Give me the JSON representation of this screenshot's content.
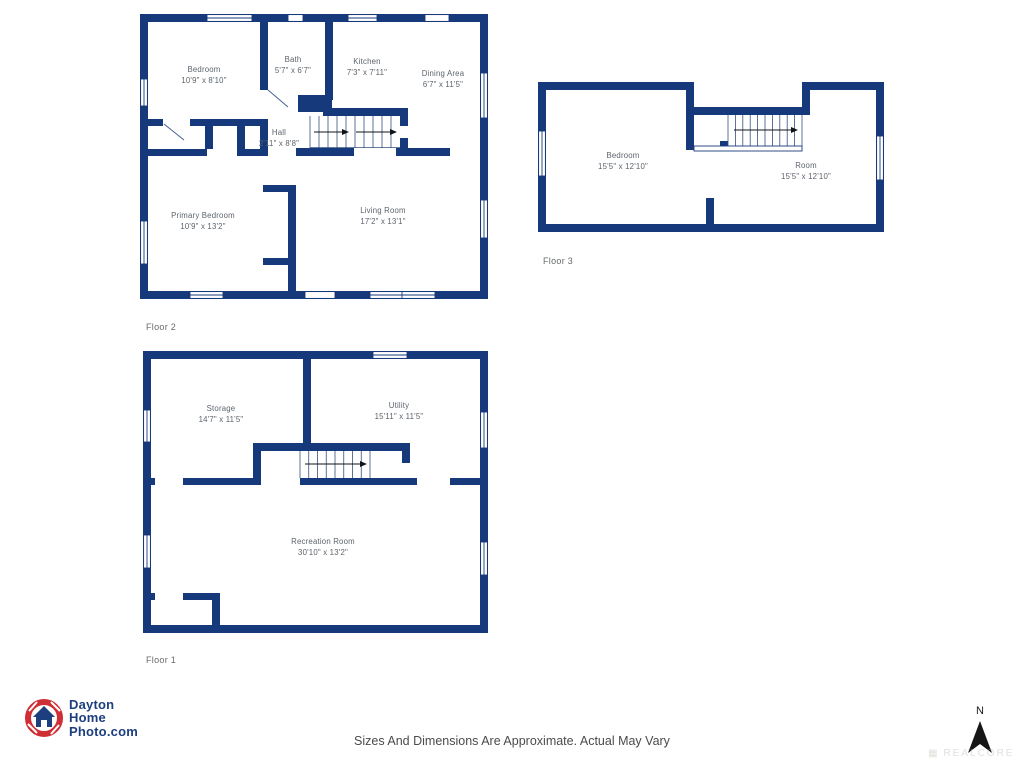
{
  "colors": {
    "wall_navy": "#16397b",
    "room_label_gray": "#5c646c",
    "floor_label_gray": "#66696c",
    "disclaimer_gray": "#4b4b4b",
    "logo_red": "#cf2e34",
    "logo_navy": "#1d3e7f",
    "north_arrow_black": "#161616"
  },
  "floor2": {
    "label": "Floor 2",
    "rooms": {
      "bedroom": {
        "name": "Bedroom",
        "dims": "10'9\" x 8'10\""
      },
      "bath": {
        "name": "Bath",
        "dims": "5'7\" x 6'7\""
      },
      "kitchen": {
        "name": "Kitchen",
        "dims": "7'3\" x 7'11\""
      },
      "dining": {
        "name": "Dining Area",
        "dims": "6'7\" x 11'5\""
      },
      "hall": {
        "name": "Hall",
        "dims": "2'11\" x 8'8\""
      },
      "primary": {
        "name": "Primary Bedroom",
        "dims": "10'9\" x 13'2\""
      },
      "living": {
        "name": "Living Room",
        "dims": "17'2\" x 13'1\""
      }
    }
  },
  "floor3": {
    "label": "Floor 3",
    "rooms": {
      "bedroom": {
        "name": "Bedroom",
        "dims": "15'5\" x 12'10\""
      },
      "room": {
        "name": "Room",
        "dims": "15'5\" x 12'10\""
      }
    }
  },
  "floor1": {
    "label": "Floor 1",
    "rooms": {
      "storage": {
        "name": "Storage",
        "dims": "14'7\" x 11'5\""
      },
      "utility": {
        "name": "Utility",
        "dims": "15'11\" x 11'5\""
      },
      "recreation": {
        "name": "Recreation Room",
        "dims": "30'10\" x 13'2\""
      }
    }
  },
  "logo": {
    "line1": "Dayton",
    "line2": "Home",
    "line3": "Photo.com"
  },
  "footer": {
    "disclaimer": "Sizes And Dimensions Are Approximate. Actual May Vary"
  },
  "compass": {
    "north_label": "N"
  },
  "watermark": {
    "text": "REALCORE"
  }
}
